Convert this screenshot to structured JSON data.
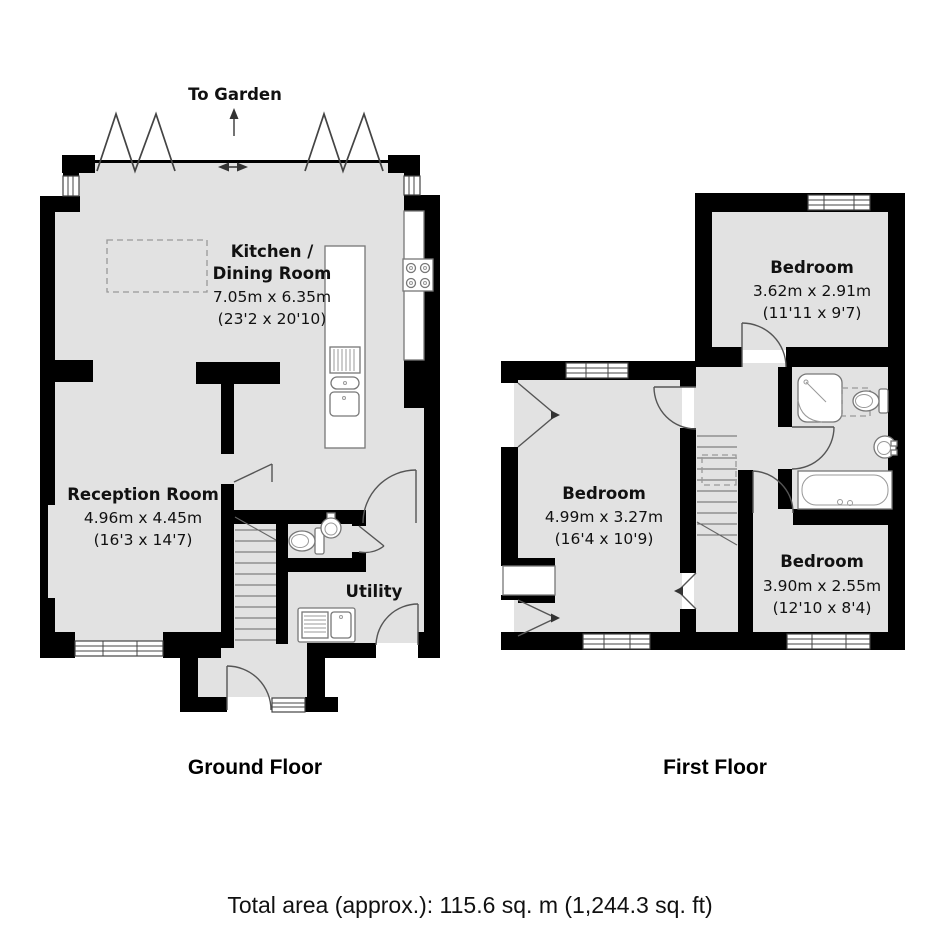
{
  "ground_floor": {
    "label": "Ground Floor",
    "to_garden_label": "To Garden",
    "rooms": {
      "kitchen_dining": {
        "name_line1": "Kitchen /",
        "name_line2": "Dining Room",
        "size_metric": "7.05m x 6.35m",
        "size_imperial": "(23'2 x 20'10)"
      },
      "reception": {
        "name": "Reception Room",
        "size_metric": "4.96m x 4.45m",
        "size_imperial": "(16'3 x 14'7)"
      },
      "utility": {
        "name": "Utility"
      }
    },
    "fixtures": [
      "bifold-doors",
      "roof-light",
      "kitchen-island-sink",
      "hob",
      "worktop",
      "wc-toilet",
      "wc-basin",
      "utility-sink",
      "stairs",
      "front-door",
      "windows"
    ]
  },
  "first_floor": {
    "label": "First Floor",
    "rooms": {
      "bedroom_top_right": {
        "name": "Bedroom",
        "size_metric": "3.62m x 2.91m",
        "size_imperial": "(11'11 x 9'7)"
      },
      "bedroom_left": {
        "name": "Bedroom",
        "size_metric": "4.99m x 3.27m",
        "size_imperial": "(16'4 x 10'9)"
      },
      "bedroom_bottom_right": {
        "name": "Bedroom",
        "size_metric": "3.90m x 2.55m",
        "size_imperial": "(12'10 x 8'4)"
      }
    },
    "fixtures": [
      "shower",
      "toilet",
      "basin",
      "bath",
      "stairs",
      "loft-hatch",
      "windows"
    ]
  },
  "footer": {
    "total_area": "Total area (approx.): 115.6 sq. m (1,244.3 sq. ft)"
  },
  "colors": {
    "wall": "#000000",
    "room_fill": "#e2e2e2",
    "fixture_stroke": "#777777",
    "door_stroke": "#555555",
    "dashed_stroke": "#999999"
  }
}
